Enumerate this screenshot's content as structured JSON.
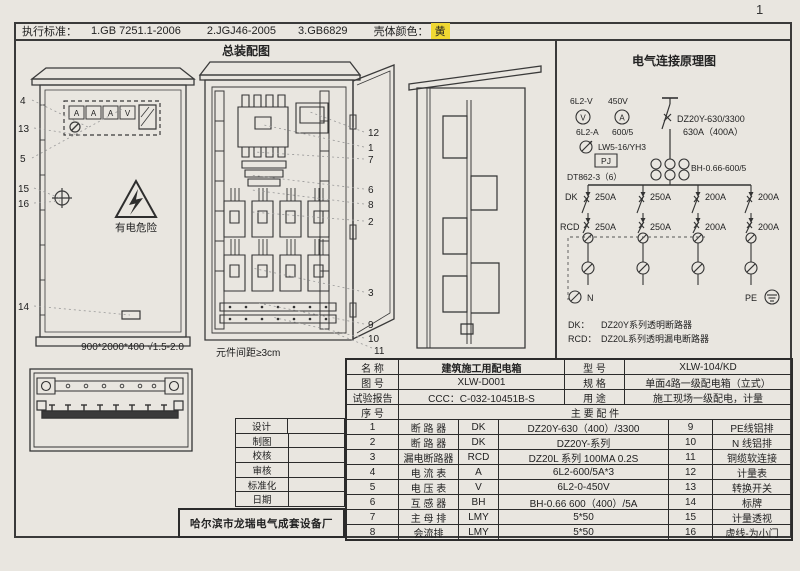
{
  "page": {
    "number": "1"
  },
  "top_bar": {
    "standards_label": "执行标准：",
    "standards": [
      "1.GB 7251.1-2006",
      "2.JGJ46-2005",
      "3.GB6829"
    ],
    "shell_color_label": "壳体颜色：",
    "shell_color_value": "黄"
  },
  "colors": {
    "highlight_yellow": "#f0d832",
    "ink": "#333333",
    "paper": "#e9e6e0"
  },
  "assembly": {
    "title": "总装配图",
    "front_callouts": [
      "4",
      "13",
      "5",
      "15",
      "16",
      "14"
    ],
    "right_callouts": [
      "12",
      "1",
      "7",
      "6",
      "8",
      "2",
      "3",
      "9",
      "10"
    ],
    "bottom_callout": "11",
    "panel_meters": [
      "A",
      "A",
      "A",
      "V"
    ],
    "warning_text": "有电危险",
    "dimension_note": "900*2000*400 √1.5-2.0",
    "spacing_note": "元件间距≥3cm"
  },
  "schematic": {
    "title": "电气连接原理图",
    "voltmeter_model": "6L2-V",
    "voltmeter_range": "450V",
    "voltmeter_symbol": "V",
    "ammeter_symbol": "A",
    "ammeter_model": "6L2-A",
    "ct_ratio": "600/5",
    "changeover_switch": "LW5-16/YH3",
    "pj_label": "PJ",
    "energy_meter": "DT862-3（6）",
    "main_breaker_model": "DZ20Y-630/3300",
    "main_breaker_rating": "630A（400A）",
    "ct_model": "BH-0.66-600/5",
    "dk_label": "DK",
    "rcd_label": "RCD",
    "dk_ratings": [
      "250A",
      "250A",
      "200A",
      "200A"
    ],
    "rcd_ratings": [
      "250A",
      "250A",
      "200A",
      "200A"
    ],
    "n_label": "N",
    "pe_label": "PE",
    "legend": [
      {
        "key": "DK：",
        "value": "DZ20Y系列透明断路器"
      },
      {
        "key": "RCD：",
        "value": "DZ20L系列透明漏电断路器"
      }
    ]
  },
  "title_block": {
    "info_rows": [
      {
        "label1": "名  称",
        "value1": "建筑施工用配电箱",
        "label2": "型  号",
        "value2": "XLW-104/KD"
      },
      {
        "label1": "图  号",
        "value1": "XLW-D001",
        "label2": "规  格",
        "value2": "单面4路一级配电箱（立式）"
      },
      {
        "label1": "试验报告",
        "value1": "CCC：C-032-10451B-S",
        "label2": "用  途",
        "value2": "施工现场一级配电，计量"
      }
    ],
    "seq_label": "序  号",
    "parts_header": "主  要  配  件",
    "parts": [
      {
        "no": "1",
        "name": "断 路 器",
        "code": "DK",
        "spec": "DZ20Y-630（400）/3300",
        "no2": "9",
        "name2": "PE线铝排"
      },
      {
        "no": "2",
        "name": "断 路 器",
        "code": "DK",
        "spec": "DZ20Y-系列",
        "no2": "10",
        "name2": "N 线铝排"
      },
      {
        "no": "3",
        "name": "漏电断路器",
        "code": "RCD",
        "spec": "DZ20L 系列  100MA 0.2S",
        "no2": "11",
        "name2": "铜缆软连接"
      },
      {
        "no": "4",
        "name": "电 流 表",
        "code": "A",
        "spec": "6L2-600/5A*3",
        "no2": "12",
        "name2": "计量表"
      },
      {
        "no": "5",
        "name": "电 压 表",
        "code": "V",
        "spec": "6L2-0-450V",
        "no2": "13",
        "name2": "转换开关"
      },
      {
        "no": "6",
        "name": "互 感 器",
        "code": "BH",
        "spec": "BH-0.66 600（400）/5A",
        "no2": "14",
        "name2": "标牌"
      },
      {
        "no": "7",
        "name": "主 母 排",
        "code": "LMY",
        "spec": "5*50",
        "no2": "15",
        "name2": "计量透视"
      },
      {
        "no": "8",
        "name": "会流排",
        "code": "LMY",
        "spec": "5*50",
        "no2": "16",
        "name2": "虚线-为小门"
      }
    ],
    "sign_labels": [
      "设计",
      "制图",
      "校核",
      "审核",
      "标准化",
      "日期"
    ],
    "company": "哈尔滨市龙瑞电气成套设备厂"
  }
}
